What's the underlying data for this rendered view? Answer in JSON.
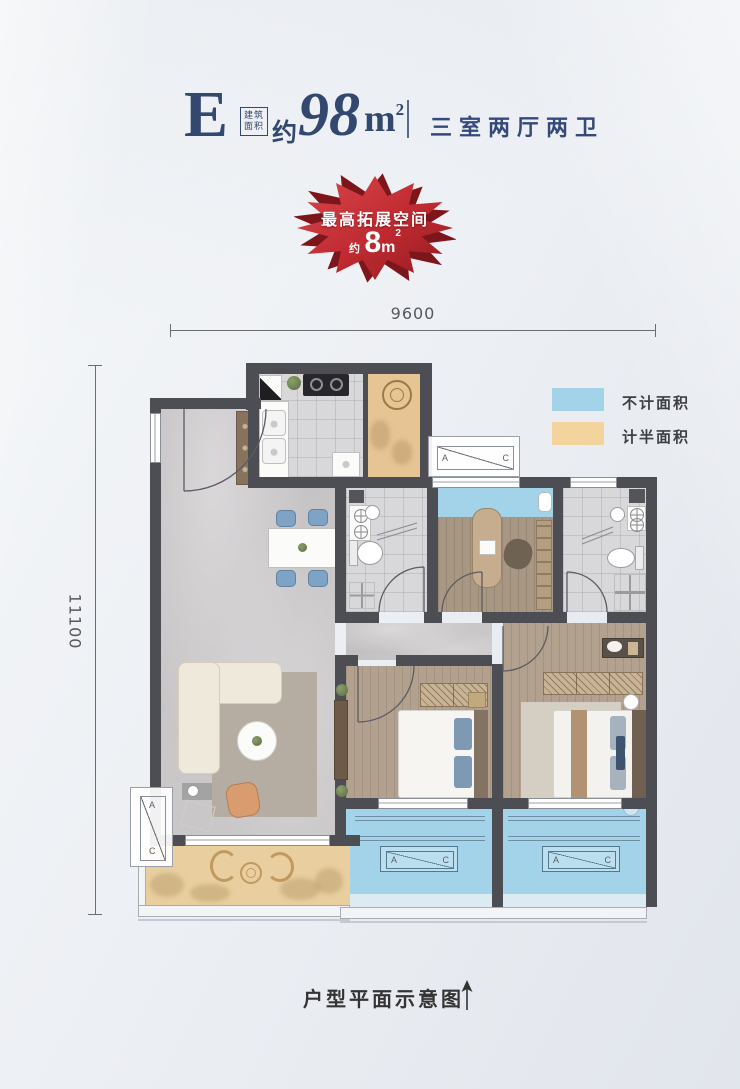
{
  "header": {
    "unit_letter": "E",
    "area_tag_top": "建筑",
    "area_tag_bottom": "面积",
    "approx_prefix": "约",
    "area_number": "98",
    "area_unit": "m",
    "area_unit_sup": "2",
    "layout_text": "三室两厅两卫"
  },
  "badge": {
    "title": "最高拓展空间",
    "approx": "约",
    "number": "8",
    "unit": "m",
    "unit_sup": "2",
    "color_main": "#c93237",
    "color_dark": "#7c161b"
  },
  "dimensions": {
    "width_label": "9600",
    "height_label": "11100"
  },
  "legend": {
    "items": [
      {
        "label": "不计面积",
        "color": "#a2d3e9"
      },
      {
        "label": "计半面积",
        "color": "#f3d49c"
      }
    ]
  },
  "plan": {
    "ac_a": "A",
    "ac_c": "C"
  },
  "footer": {
    "caption": "户型平面示意图"
  },
  "colors": {
    "title_navy": "#33486f",
    "wall": "#4d4d54",
    "no_count_blue": "#a2d3e9",
    "half_count_tan": "#f3d49c"
  }
}
